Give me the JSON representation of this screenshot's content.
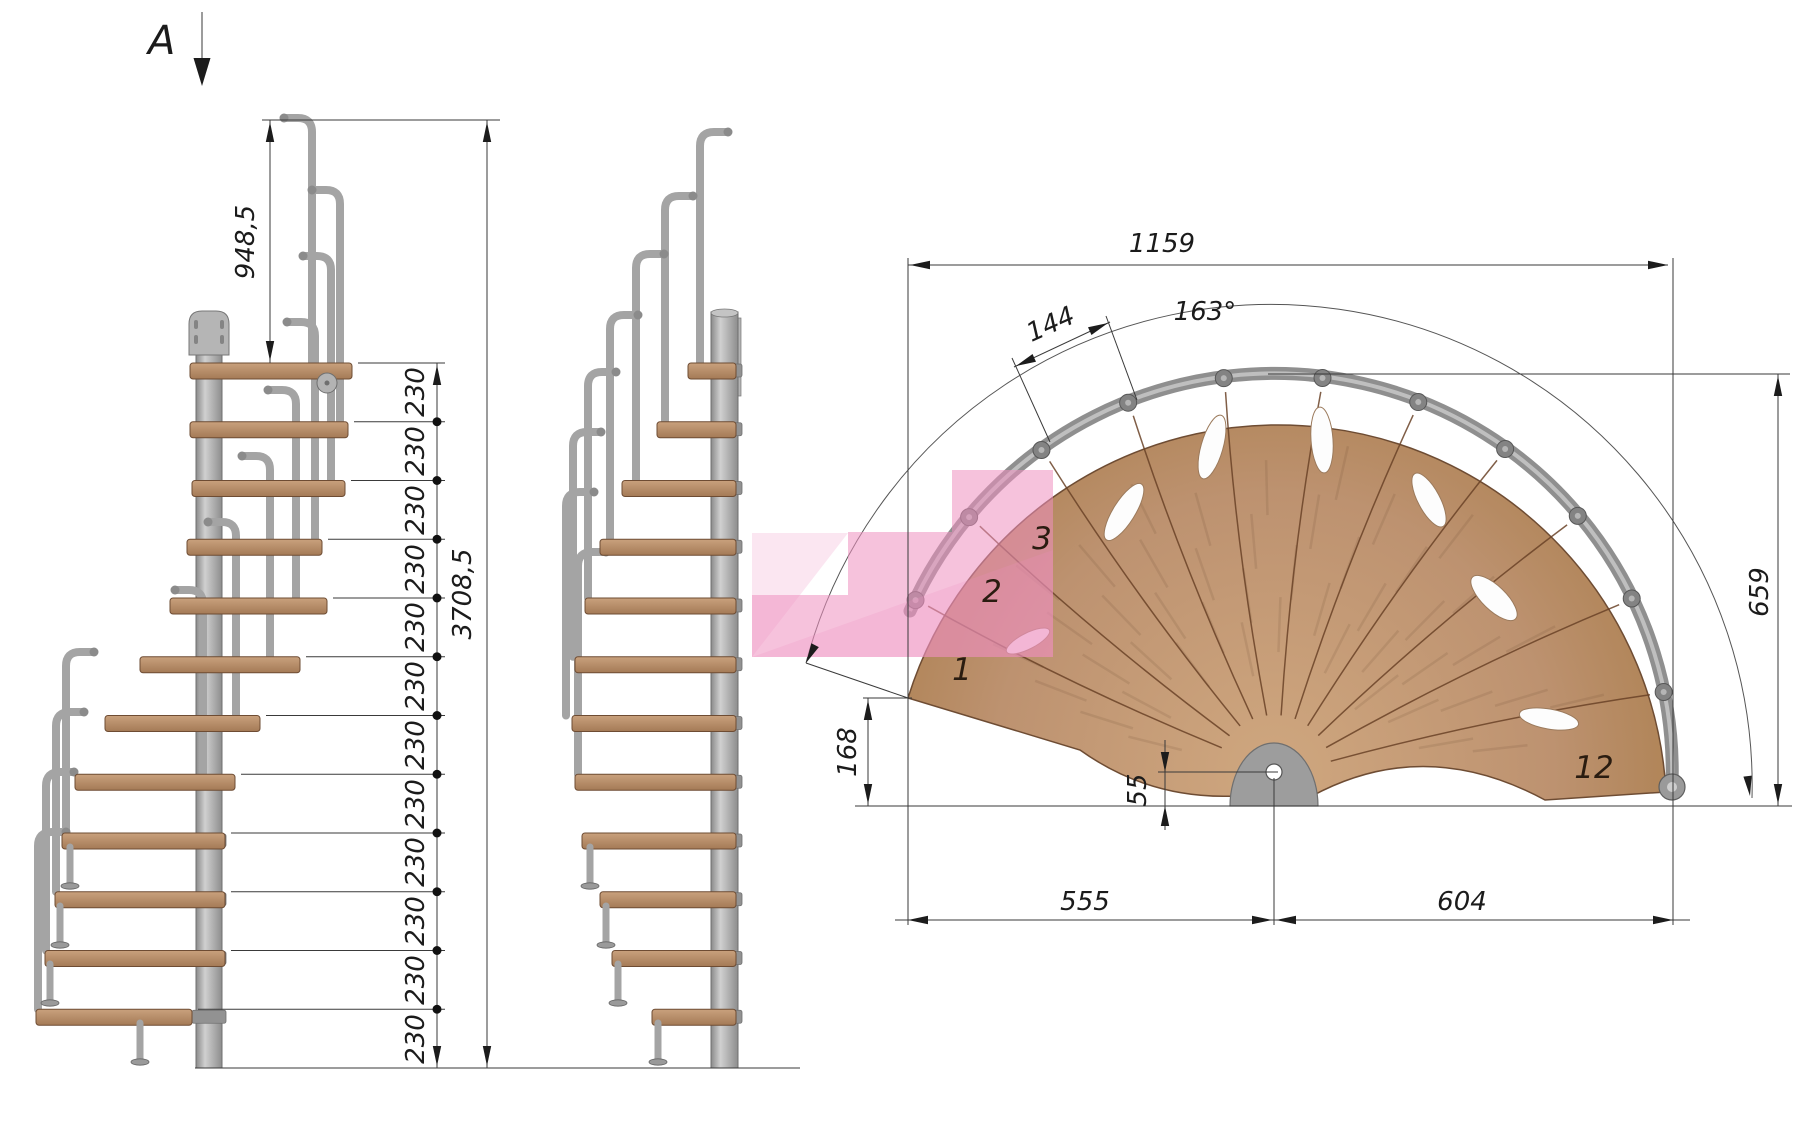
{
  "section_marker": {
    "label": "A"
  },
  "side_view": {
    "top_riser_height": "948,5",
    "total_height": "3708,5",
    "riser_heights": [
      "230",
      "230",
      "230",
      "230",
      "230",
      "230",
      "230",
      "230",
      "230",
      "230",
      "230",
      "230"
    ]
  },
  "plan_view": {
    "overall_width": "1159",
    "sweep_angle": "163°",
    "tread_outer_width": "144",
    "right_depth": "659",
    "entry_depth": "168",
    "center_offset": "55",
    "left_half_width": "555",
    "right_half_width": "604",
    "tread_numbers": [
      "1",
      "2",
      "3",
      "12"
    ]
  },
  "colors": {
    "wood": "#b4896b",
    "metal": "#a6a6a6",
    "highlight_pink": "#ee8fc0",
    "dimension_ink": "#333333"
  }
}
